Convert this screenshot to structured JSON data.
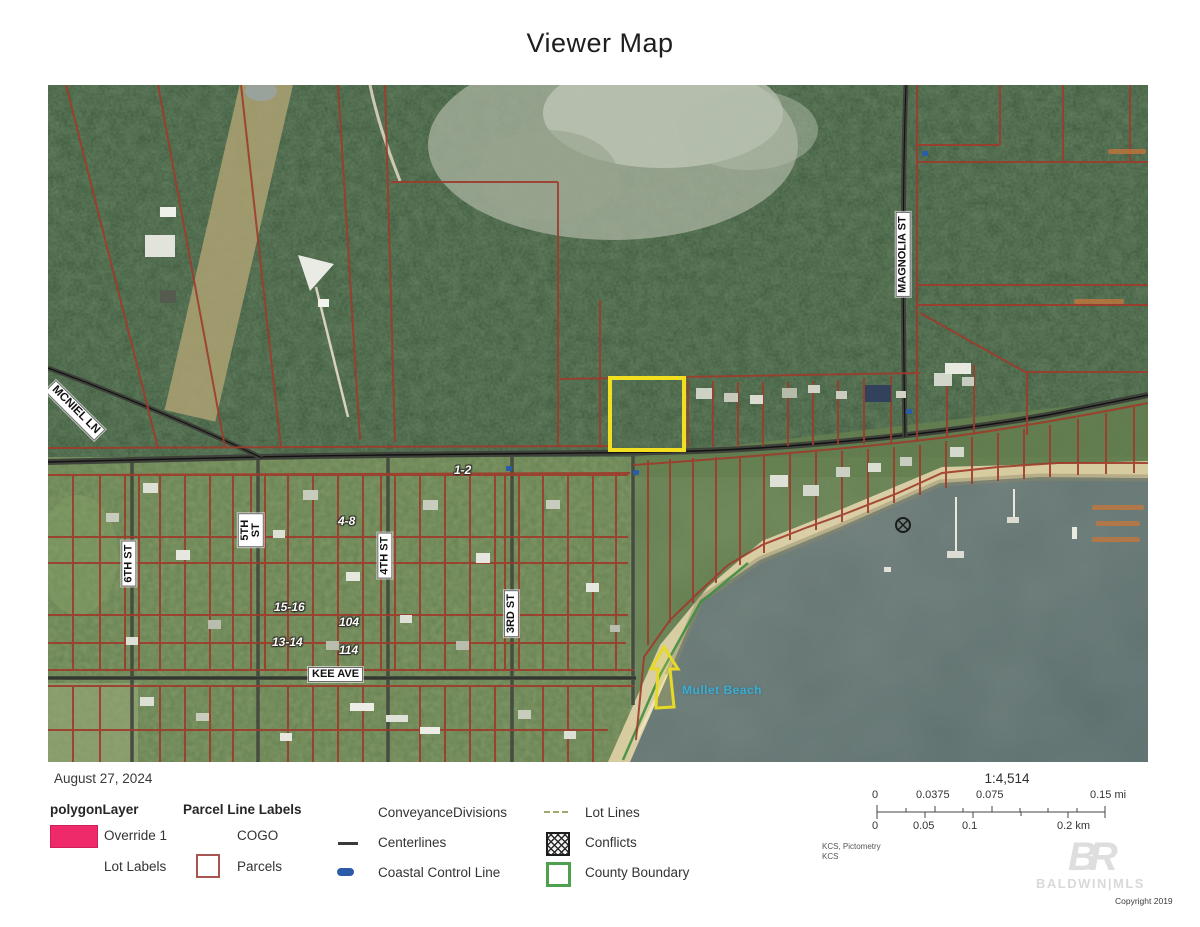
{
  "title": "Viewer Map",
  "map": {
    "streets": {
      "mcniel": "MCNIEL LN",
      "magnolia": "MAGNOLIA ST",
      "sixth": "6TH ST",
      "fifth": "5TH ST",
      "fourth": "4TH ST",
      "third": "3RD ST",
      "kee": "KEE AVE"
    },
    "parcel_labels": {
      "p12": "1-2",
      "p48": "4-8",
      "p1516": "15-16",
      "p1314": "13-14",
      "p104": "104",
      "p114": "114"
    },
    "water_label": "Mullet Beach",
    "highlight_parcel_color": "#f2df1f",
    "parcel_line_color": "#9e3b2b"
  },
  "legend": {
    "date": "August 27, 2024",
    "col1": {
      "heading": "polygonLayer",
      "item1": "Override 1",
      "item2": "Lot Labels",
      "override_color": "#ee2a6a"
    },
    "col2": {
      "heading": "Parcel Line Labels",
      "item1": "COGO",
      "item2": "Parcels",
      "parcels_color": "#a85450"
    },
    "col3": {
      "item1": "ConveyanceDivisions",
      "item2": "Centerlines",
      "item3": "Coastal Control Line",
      "centerline_color": "#3a3a3a",
      "coastal_color": "#2b5ca8"
    },
    "col4": {
      "item1": "Lot Lines",
      "item2": "Conflicts",
      "item3": "County Boundary",
      "lot_lines_color": "#9aa86a",
      "county_color": "#4ea04e"
    }
  },
  "scale": {
    "ratio": "1:4,514",
    "mi_0": "0",
    "mi_1": "0.0375",
    "mi_2": "0.075",
    "mi_3": "0.15 mi",
    "km_0": "0",
    "km_1": "0.05",
    "km_2": "0.1",
    "km_3": "0.2 km"
  },
  "attribution": {
    "line1": "KCS, Pictometry",
    "line2": "KCS"
  },
  "logo": {
    "monogram": "BR",
    "name": "BALDWIN|MLS",
    "copyright": "Copyright 2019"
  }
}
